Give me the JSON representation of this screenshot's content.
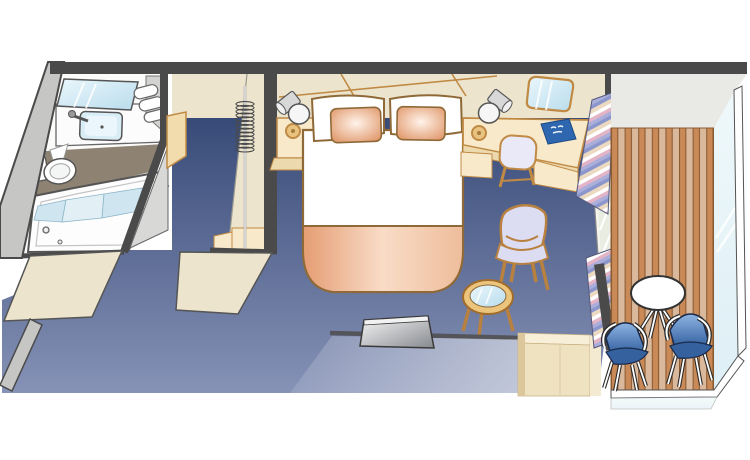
{
  "diagram": {
    "type": "floorplan",
    "description": "Cruise ship balcony stateroom floor plan diagram, isometric top view"
  },
  "colors": {
    "wall-dark": "#4a4a4a",
    "wall-gray": "#c6c6c4",
    "wall-gray-edge": "#8f8f8d",
    "cream": "#ece4cd",
    "beige": "#f7e9c9",
    "beige-dark": "#ecd9ad",
    "beige-shadow": "#dcc79c",
    "tan": "#c08a45",
    "brown": "#8f6a38",
    "carpet-top": "#2b3f6e",
    "carpet-bottom": "#8692b6",
    "taupe-floor": "#8e8372",
    "mirror-blue": "#cfe9f5",
    "mirror-blue-deep": "#b9dcec",
    "sink-blue": "#d9edf6",
    "peach": "#dd8d5c",
    "peach-light": "#fbe3d2",
    "blanket-peach": "#e59d73",
    "book-blue": "#2e66b0",
    "lavender": "#dcdcf2",
    "deck-wood": "#c98a58",
    "deck-wood-light": "#d9b89c",
    "deck-seam": "#8a5a32",
    "chair-blue-light": "#8fb4e2",
    "chair-blue-dark": "#1c4c90",
    "glass": "#dceef5",
    "ceiling-gray": "#e9e9e6",
    "curtain-pink": "#e3b3c6",
    "curtain-lavender": "#a9aeda",
    "curtain-blue": "#8b97cc",
    "curtain-tan": "#ecd9c2",
    "fixture-gray": "#555555"
  },
  "rooms": {
    "bathroom": {
      "items": [
        "vanity-mirror",
        "sink",
        "faucet",
        "towel-stack",
        "toilet",
        "bathtub",
        "shower-curtain",
        "bathroom-door"
      ]
    },
    "entry": {
      "items": [
        "entry-door",
        "corridor",
        "cut-wall-bathroom",
        "cut-wall-closet"
      ]
    },
    "closet": {
      "items": [
        "hanger-rod",
        "hangers-coil",
        "step-shelf",
        "wardrobe-panel"
      ]
    },
    "bedroom": {
      "items": [
        "queen-bed",
        "pillows",
        "accent-pillows",
        "foot-blanket",
        "nightstand",
        "table-lamp-left",
        "table-lamp-right",
        "desk-counter",
        "desk-knob",
        "desk-chair",
        "desk-mirror",
        "guide-book",
        "armchair",
        "coffee-table",
        "tv",
        "low-cabinet",
        "curtain-top",
        "curtain-bottom",
        "carpet"
      ]
    },
    "balcony": {
      "items": [
        "sliding-glass-door",
        "overhang-ceiling",
        "wood-deck",
        "glass-railing",
        "round-table",
        "deck-chair-left",
        "deck-chair-right"
      ]
    }
  }
}
